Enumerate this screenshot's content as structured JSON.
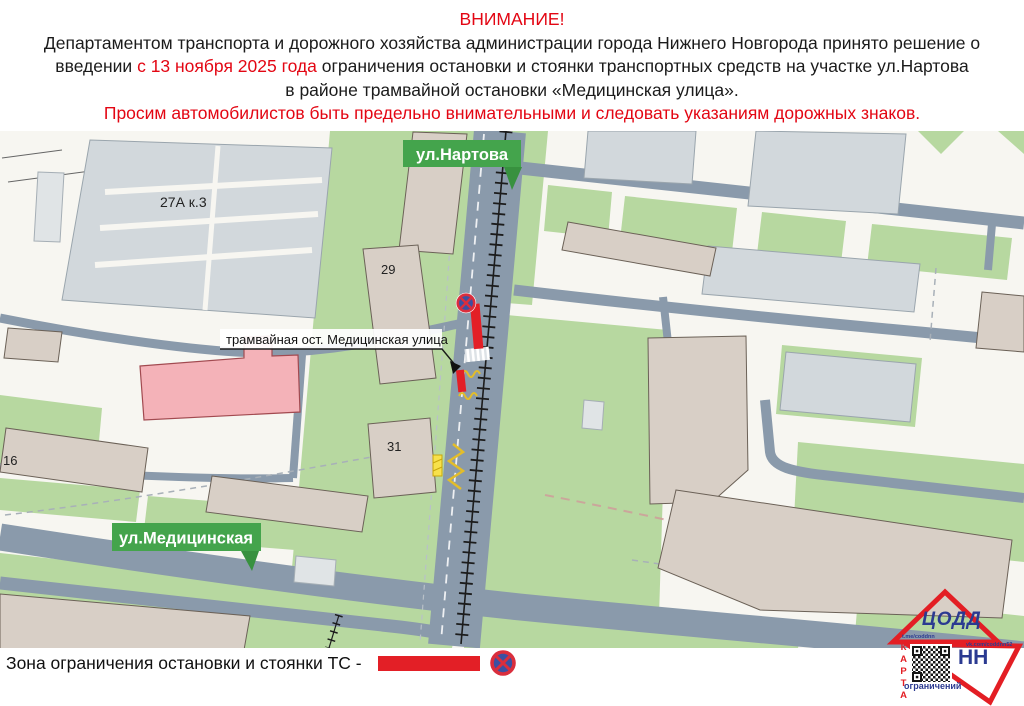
{
  "header": {
    "title": "ВНИМАНИЕ!",
    "line1": "Департаментом транспорта и дорожного хозяйства администрации города Нижнего Новгорода принято решение о",
    "line2_pre": "введении ",
    "line2_red": "с 13 ноября 2025 года",
    "line2_post": " ограничения остановки и стоянки транспортных средств на участке ул.Нартова",
    "line3": "в районе трамвайной остановки «Медицинская улица».",
    "warning": "Просим автомобилистов быть предельно внимательными и следовать указаниям дорожных знаков."
  },
  "map": {
    "street_labels": {
      "nartova": "ул.Нартова",
      "medicinskaya": "ул.Медицинская"
    },
    "tram_stop_label": "трамвайная ост. Медицинская улица",
    "building_numbers": {
      "b27": "27А к.3",
      "b29": "29",
      "b31": "31",
      "b16": "16"
    }
  },
  "legend": {
    "text": "Зона ограничения остановки и стоянки ТС -"
  },
  "logo": {
    "org": "ЦОДД",
    "city": "НН",
    "map_word": "КАРТА",
    "map_word_suffix": "ограничений",
    "telegram": "t.me/coddnn",
    "vk": "vk.com/coddnn52"
  },
  "colors": {
    "alert_red": "#e30613",
    "restriction_red": "#e31f26",
    "badge_green": "#44a44c",
    "map_green": "#b7d8a0",
    "road_gray": "#8a9aab",
    "logo_blue": "#2b3a91",
    "sign_blue": "#3c50a2"
  }
}
